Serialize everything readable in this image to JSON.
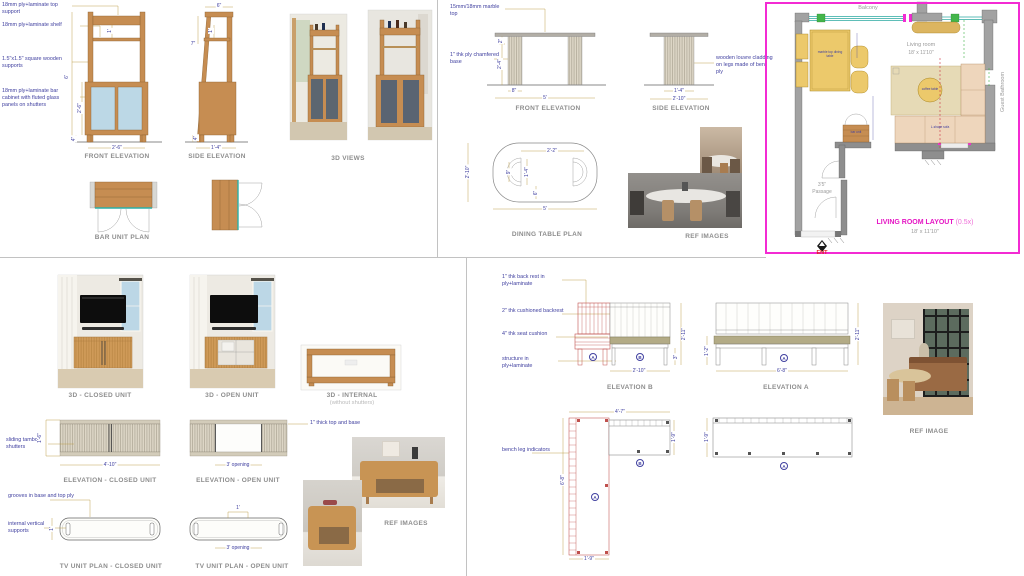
{
  "bar_unit": {
    "notes": {
      "top_support": "18mm ply+laminate top support",
      "shelf": "18mm ply+laminate shelf",
      "supports": "1.5\"x1.5\" square wooden supports",
      "cabinet": "18mm ply+laminate bar cabinet with fluted glass panels on shutters"
    },
    "front": {
      "title": "FRONT ELEVATION",
      "height": "6'",
      "cabinet_height": "2'-6\"",
      "shelf_gap": "1'",
      "leg": "4\"",
      "width": "2'-6\""
    },
    "side": {
      "title": "SIDE ELEVATION",
      "top": "6\"",
      "shelf_gap": "1'",
      "slant": "7\"",
      "leg": "4\"",
      "width": "1'-4\""
    },
    "views_3d_title": "3D VIEWS",
    "plan_title": "BAR UNIT PLAN"
  },
  "dining_table": {
    "notes": {
      "marble": "15mm/18mm marble top",
      "base": "1\" thk ply chamfered base",
      "louvre": "wooden louvre cladding on legs made of bent ply"
    },
    "front": {
      "title": "FRONT ELEVATION",
      "top_thk": "2\"",
      "leg_height": "2'-4\"",
      "leg_width": "8\"",
      "width": "5'"
    },
    "side": {
      "title": "SIDE ELEVATION",
      "leg_width": "1'-4\"",
      "width": "2'-10\""
    },
    "plan": {
      "title": "DINING TABLE PLAN",
      "leg_span": "2'-2\"",
      "depth": "2'-10\"",
      "leg_gap": "1'-4\"",
      "leg_depth": "9\"",
      "offset": "6\"",
      "width": "5'"
    },
    "ref_title": "REF IMAGES"
  },
  "living_room": {
    "balcony": "Balcony",
    "room": "Living room",
    "room_size": "18' x 11'10\"",
    "guest_bathroom": "Guest Bathroom",
    "passage_size": "3'5\"",
    "passage": "Passage",
    "entry": "ENT",
    "title": "LIVING ROOM LAYOUT",
    "scale": "(0.5x)",
    "size": "18' x 11'10\"",
    "annotations": {
      "dining": "marble top dining table",
      "bar": "bar unit",
      "coffee": "coffee table",
      "sofa": "L-shape sofa"
    }
  },
  "tv_unit": {
    "closed_3d": "3D - CLOSED UNIT",
    "open_3d": "3D - OPEN UNIT",
    "internal_3d": "3D - INTERNAL",
    "internal_sub": "(without shutters)",
    "notes": {
      "tambour": "sliding tambour shutters",
      "top_base": "1\" thick top and base",
      "grooves": "grooves in base and top ply",
      "supports": "internal vertical supports"
    },
    "elev_closed": {
      "title": "ELEVATION - CLOSED UNIT",
      "height": "1'-6\"",
      "width": "4'-10\""
    },
    "elev_open": {
      "title": "ELEVATION - OPEN UNIT",
      "opening": "3' opening"
    },
    "plan_closed": {
      "title": "TV UNIT PLAN - CLOSED UNIT",
      "depth": "1'"
    },
    "plan_open": {
      "title": "TV UNIT PLAN - OPEN UNIT",
      "top": "1'",
      "opening": "3' opening"
    },
    "ref_title": "REF IMAGES"
  },
  "bench": {
    "notes": {
      "backrest": "1\" thk back rest in ply+laminate",
      "cushion_back": "2\" thk cushioned backrest",
      "seat": "4\" thk seat cushion",
      "structure": "structure in ply+laminate",
      "legs": "bench leg indicators"
    },
    "elev_b": {
      "title": "ELEVATION B",
      "height": "2'-11\"",
      "seat": "3\"",
      "width": "2'-10\""
    },
    "elev_a": {
      "title": "ELEVATION A",
      "seat_h": "1'-2\"",
      "height": "2'-11\"",
      "width": "6'-8\""
    },
    "plan": {
      "top": "4'-7\"",
      "right": "1'-9\"",
      "left": "6'-8\"",
      "bottom": "1'-9\"",
      "depth": "1'-9\""
    },
    "markers": {
      "a": "A",
      "b": "B"
    },
    "ref_title": "REF IMAGE"
  }
}
